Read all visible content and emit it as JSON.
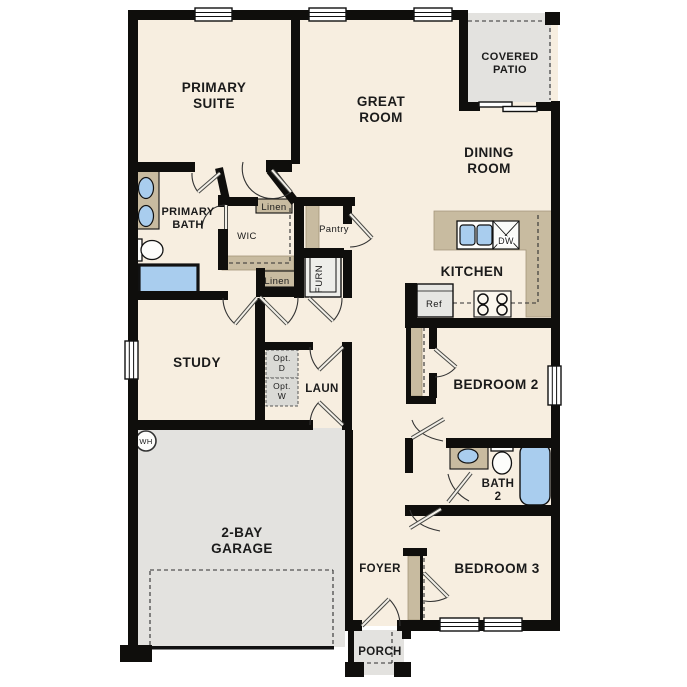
{
  "plan": {
    "type": "single-story-floor-plan",
    "canvas": {
      "width": 687,
      "height": 687
    }
  },
  "colors": {
    "floor": "#f7eee0",
    "walls": "#0f0e0c",
    "counters_closets": "#c8bba0",
    "garage_patio_porch": "#e3e2df",
    "plumbing_fixtures": "#a9cdee",
    "appliance_boxes": "#e6e6e3",
    "background": "#ffffff"
  },
  "labels": [
    {
      "id": "primary-suite",
      "lines": [
        "PRIMARY",
        "SUITE"
      ],
      "x": 214,
      "y": 92,
      "size": 13.5,
      "bold": true,
      "lh": 16
    },
    {
      "id": "great-room",
      "lines": [
        "GREAT",
        "ROOM"
      ],
      "x": 381,
      "y": 106,
      "size": 13.5,
      "bold": true,
      "lh": 16
    },
    {
      "id": "covered-patio",
      "lines": [
        "COVERED",
        "PATIO"
      ],
      "x": 510,
      "y": 60,
      "size": 11,
      "bold": true,
      "lh": 13
    },
    {
      "id": "dining-room",
      "lines": [
        "DINING",
        "ROOM"
      ],
      "x": 489,
      "y": 157,
      "size": 13.5,
      "bold": true,
      "lh": 16
    },
    {
      "id": "kitchen",
      "lines": [
        "KITCHEN"
      ],
      "x": 472,
      "y": 276,
      "size": 13.5,
      "bold": true
    },
    {
      "id": "primary-bath",
      "lines": [
        "PRIMARY",
        "BATH"
      ],
      "x": 188,
      "y": 215,
      "size": 11,
      "bold": true,
      "lh": 13
    },
    {
      "id": "wic",
      "lines": [
        "WIC"
      ],
      "x": 247,
      "y": 239,
      "size": 9.5,
      "bold": false
    },
    {
      "id": "pantry",
      "lines": [
        "Pantry"
      ],
      "x": 334,
      "y": 232,
      "size": 9.5,
      "bold": false
    },
    {
      "id": "linen-upper",
      "lines": [
        "Linen"
      ],
      "x": 274,
      "y": 210,
      "size": 9.5,
      "bold": false
    },
    {
      "id": "linen-lower",
      "lines": [
        "Linen"
      ],
      "x": 277,
      "y": 284,
      "size": 9.5,
      "bold": false
    },
    {
      "id": "furnace",
      "lines": [
        "FURN"
      ],
      "x": 322,
      "y": 279,
      "size": 9.5,
      "bold": false,
      "rotate": -90
    },
    {
      "id": "study",
      "lines": [
        "STUDY"
      ],
      "x": 197,
      "y": 367,
      "size": 13.5,
      "bold": true
    },
    {
      "id": "opt-dryer",
      "lines": [
        "Opt.",
        "D"
      ],
      "x": 282,
      "y": 361,
      "size": 8.5,
      "bold": false,
      "lh": 10
    },
    {
      "id": "opt-washer",
      "lines": [
        "Opt.",
        "W"
      ],
      "x": 282,
      "y": 389,
      "size": 8.5,
      "bold": false,
      "lh": 10
    },
    {
      "id": "laundry",
      "lines": [
        "LAUN"
      ],
      "x": 322,
      "y": 392,
      "size": 11.5,
      "bold": true
    },
    {
      "id": "water-heater",
      "lines": [
        "WH"
      ],
      "x": 146,
      "y": 444,
      "size": 7.5,
      "bold": false
    },
    {
      "id": "garage",
      "lines": [
        "2-BAY",
        "GARAGE"
      ],
      "x": 242,
      "y": 537,
      "size": 13.5,
      "bold": true,
      "lh": 16
    },
    {
      "id": "refrigerator",
      "lines": [
        "Ref"
      ],
      "x": 434,
      "y": 307,
      "size": 9.5,
      "bold": false
    },
    {
      "id": "dishwasher",
      "lines": [
        "DW"
      ],
      "x": 506,
      "y": 244,
      "size": 9,
      "bold": false,
      "halo": true
    },
    {
      "id": "bedroom-2",
      "lines": [
        "BEDROOM 2"
      ],
      "x": 496,
      "y": 389,
      "size": 13.5,
      "bold": true
    },
    {
      "id": "bath-2",
      "lines": [
        "BATH",
        "2"
      ],
      "x": 498,
      "y": 487,
      "size": 11.5,
      "bold": true,
      "lh": 13
    },
    {
      "id": "bedroom-3",
      "lines": [
        "BEDROOM 3"
      ],
      "x": 497,
      "y": 573,
      "size": 13.5,
      "bold": true
    },
    {
      "id": "foyer",
      "lines": [
        "FOYER"
      ],
      "x": 380,
      "y": 572,
      "size": 11.5,
      "bold": true
    },
    {
      "id": "porch",
      "lines": [
        "PORCH"
      ],
      "x": 380,
      "y": 655,
      "size": 11.5,
      "bold": true
    }
  ],
  "rooms": [
    "PRIMARY SUITE",
    "GREAT ROOM",
    "COVERED PATIO",
    "DINING ROOM",
    "KITCHEN",
    "PRIMARY BATH",
    "WIC",
    "STUDY",
    "LAUN",
    "2-BAY GARAGE",
    "BEDROOM 2",
    "BATH 2",
    "BEDROOM 3",
    "FOYER",
    "PORCH"
  ],
  "features": [
    "Pantry",
    "Linen",
    "Linen",
    "FURN",
    "Opt. D",
    "Opt. W",
    "WH",
    "Ref",
    "DW"
  ]
}
